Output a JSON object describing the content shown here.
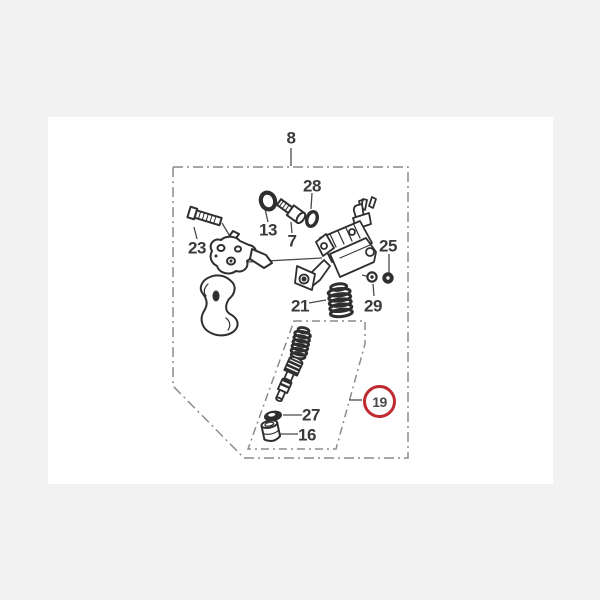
{
  "scene": {
    "background_color": "#f2f2f3",
    "sheet_color": "#ffffff",
    "border_gray": "#8c8c8c",
    "ink_color": "#2f2f2f",
    "leader_color": "#4a4a4a",
    "label_color": "#3a3a3a",
    "highlight_color": "#bf2a30"
  },
  "diagram": {
    "kind": "exploded-parts-diagram",
    "highlighted_part": "19"
  },
  "labels": {
    "p8": "8",
    "p28": "28",
    "p13": "13",
    "p7": "7",
    "p23": "23",
    "p25": "25",
    "p21": "21",
    "p29": "29",
    "p27": "27",
    "p16": "16",
    "p19": "19"
  }
}
